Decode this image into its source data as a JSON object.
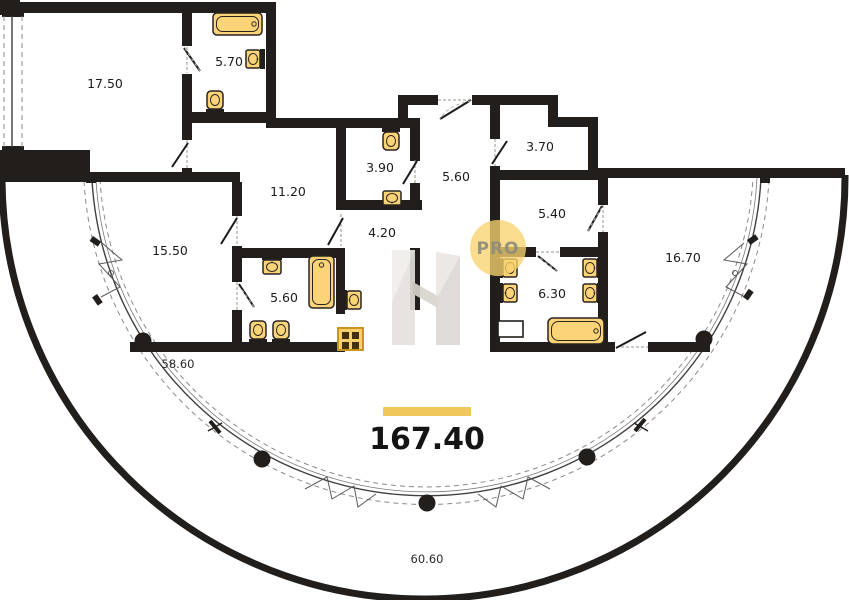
{
  "plan": {
    "total_area": "167.40",
    "outdoor": {
      "glazed_terrace": "58.60",
      "open_balcony": "60.60"
    },
    "rooms": [
      "17.50",
      "5.70",
      "11.20",
      "3.90",
      "5.60",
      "3.70",
      "5.40",
      "4.20",
      "15.50",
      "5.60",
      "6.30",
      "16.70"
    ],
    "watermark": {
      "letter": "H",
      "badge": "PRO"
    },
    "colors": {
      "wall": "#211e1b",
      "fixture_fill": "#FBD478",
      "accent_bar": "#F0C75A",
      "watermark_badge_fill": "#F7D26E",
      "watermark_badge_text": "#8f8c7c",
      "stove_frame": "#C9941C"
    }
  }
}
